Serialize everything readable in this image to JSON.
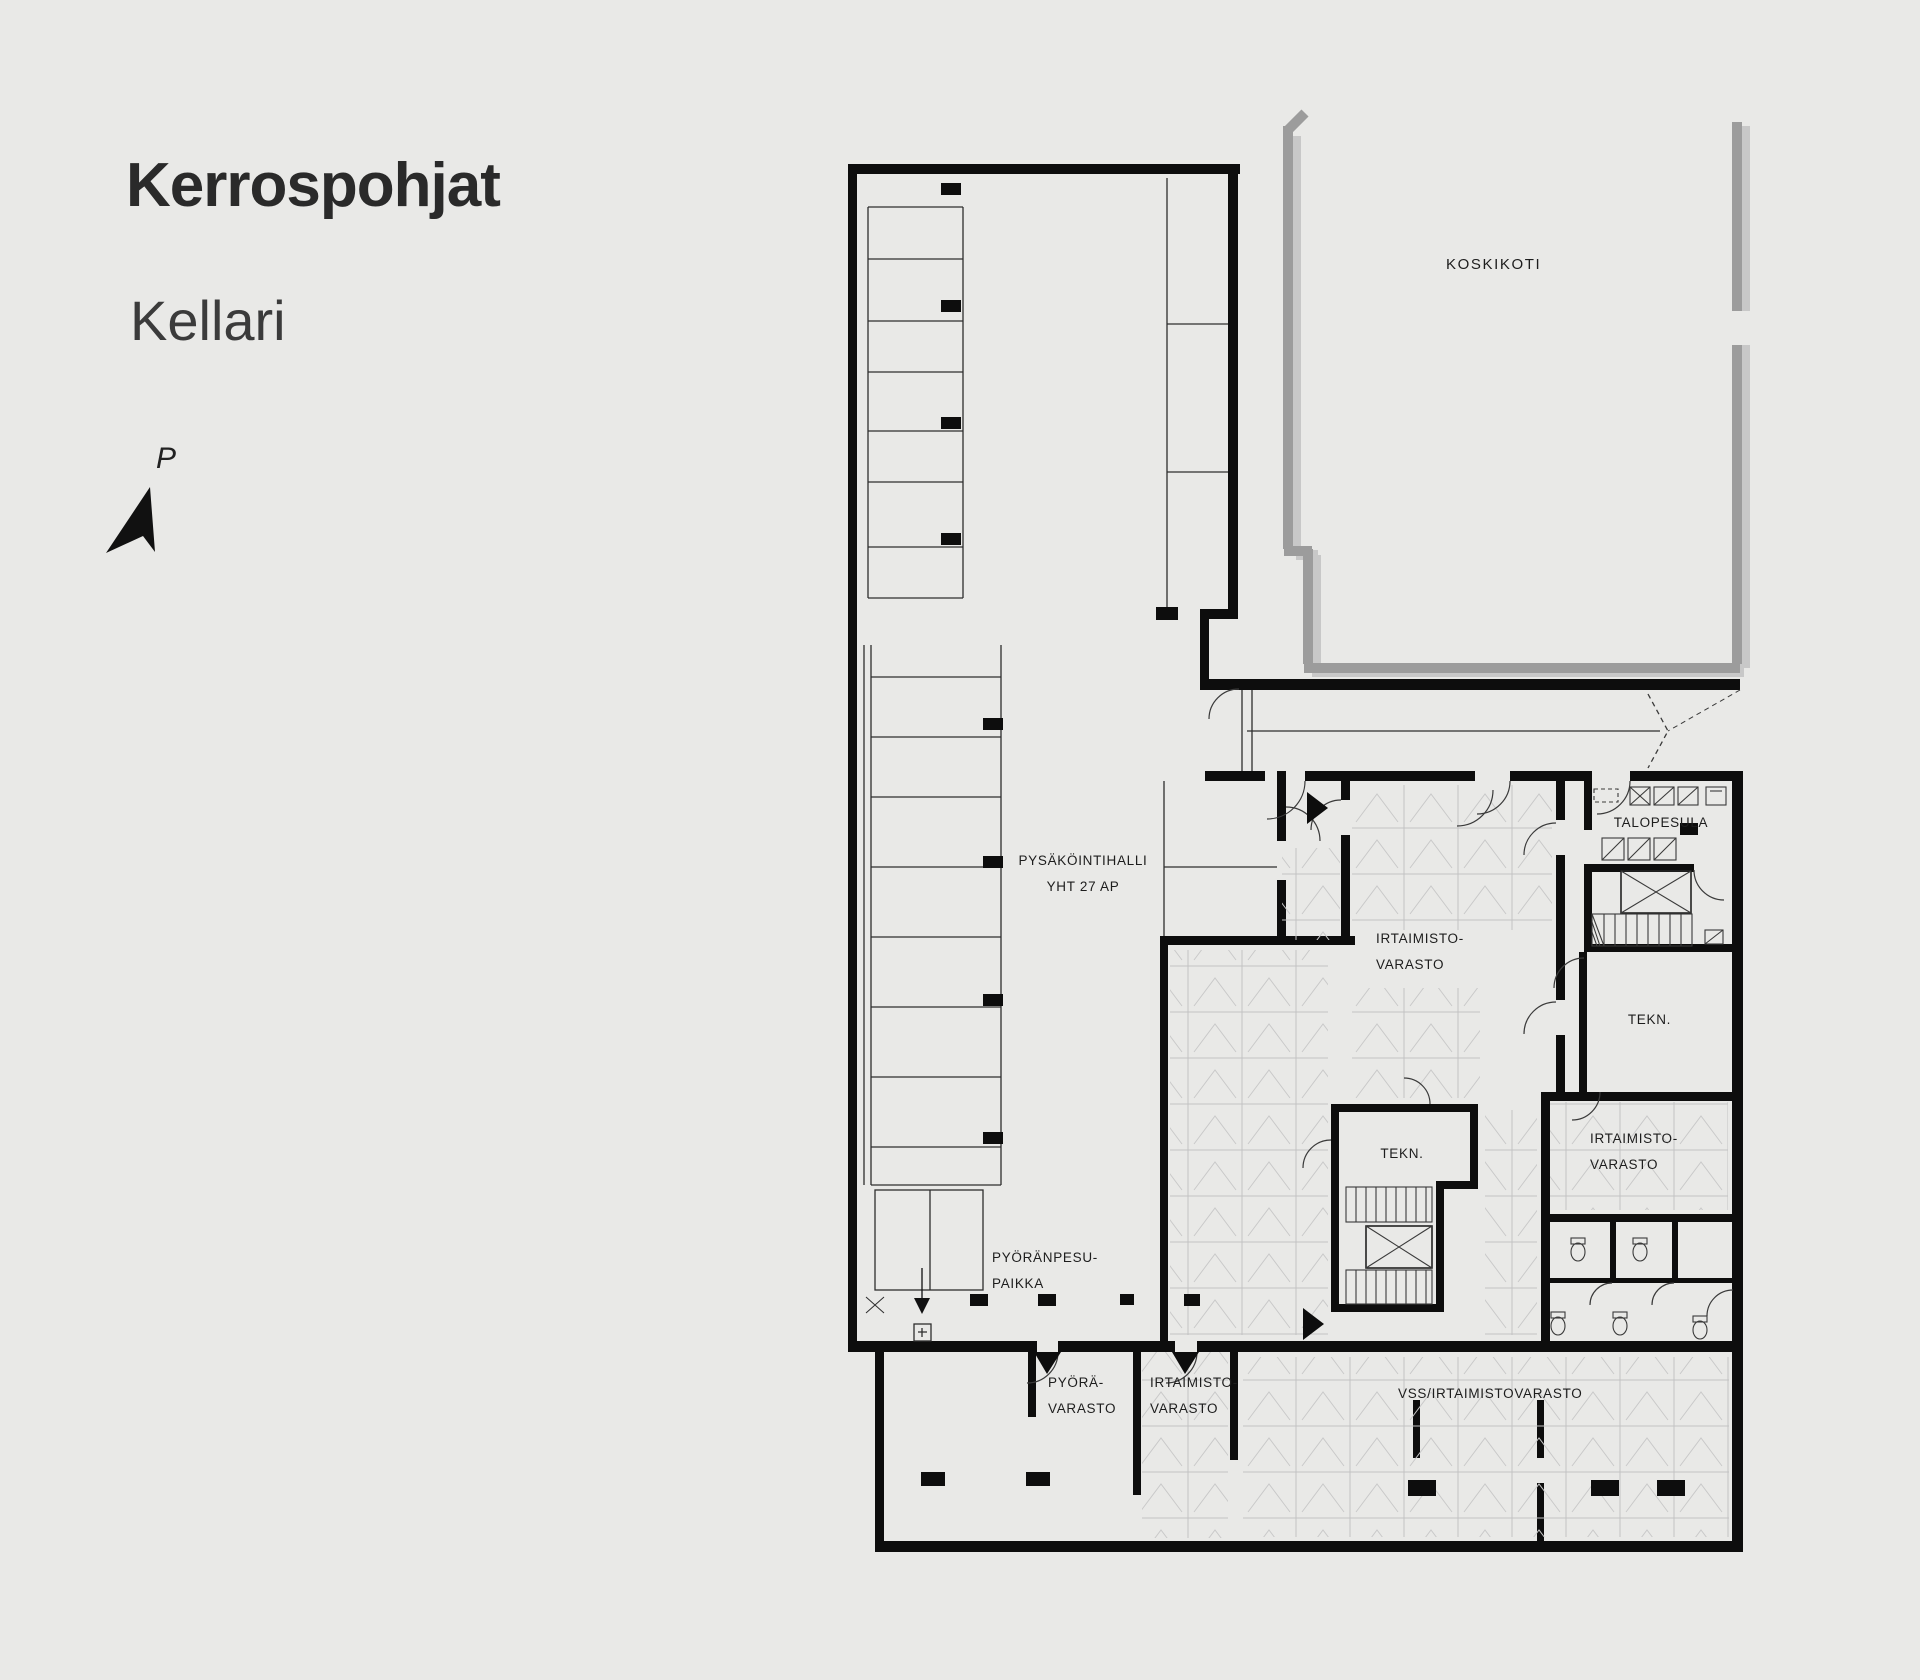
{
  "header": {
    "title": "Kerrospohjat",
    "subtitle": "Kellari"
  },
  "compass": {
    "label": "P"
  },
  "plan": {
    "neighbor_building_label": "KOSKIKOTI",
    "parking_hall": {
      "name": "PYSÄKÖINTIHALLI",
      "capacity": "YHT 27 AP"
    },
    "rooms": {
      "storage_main": {
        "line1": "IRTAIMISTO-",
        "line2": "VARASTO"
      },
      "laundry": {
        "label": "TALOPESULA"
      },
      "technical_right": {
        "label": "TEKN."
      },
      "technical_center": {
        "label": "TEKN."
      },
      "storage_right": {
        "line1": "IRTAIMISTO-",
        "line2": "VARASTO"
      },
      "bike_wash": {
        "line1": "PYÖRÄNPESU-",
        "line2": "PAIKKA"
      },
      "bike_storage": {
        "line1": "PYÖRÄ-",
        "line2": "VARASTO"
      },
      "storage_bottom": {
        "line1": "IRTAIMISTO-",
        "line2": "VARASTO"
      },
      "shelter_storage": {
        "label": "VSS/IRTAIMISTOVARASTO"
      }
    }
  }
}
